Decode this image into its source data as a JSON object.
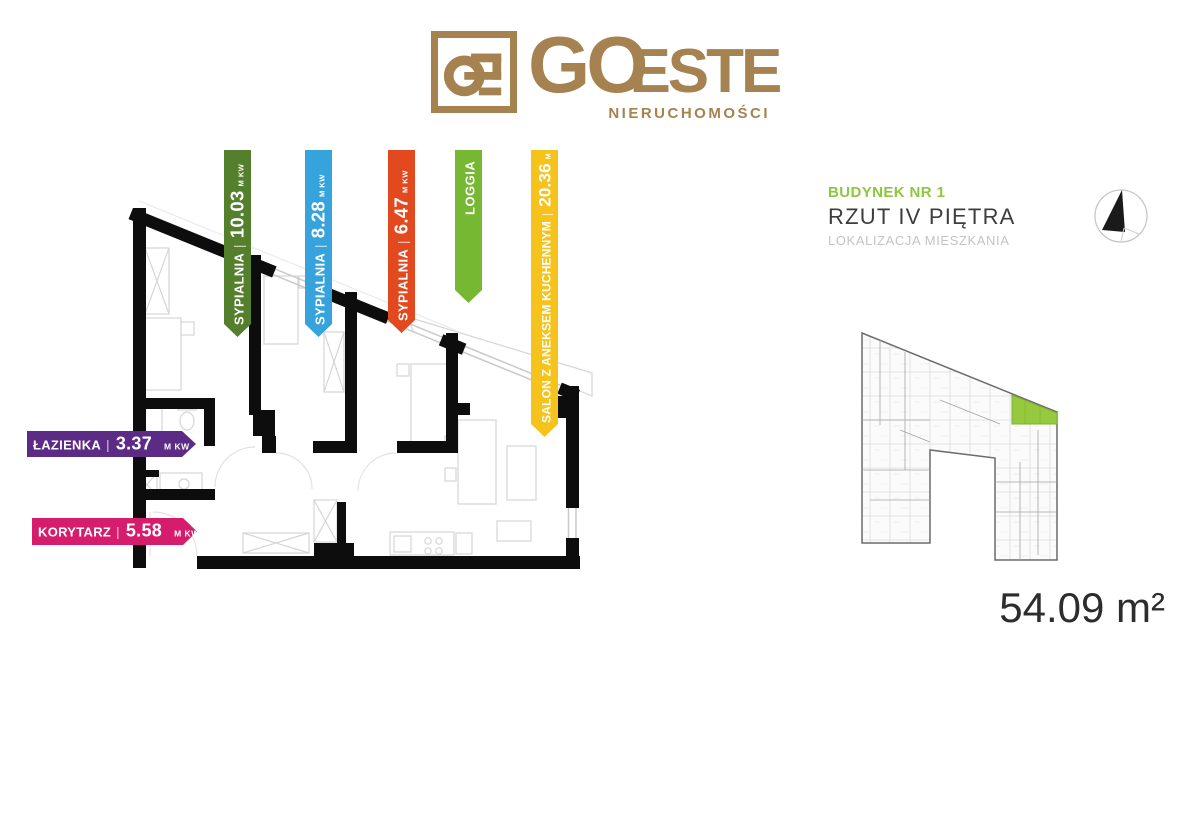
{
  "brand": {
    "monogram": "GE",
    "wordmark_go": "GO",
    "wordmark_este": "ESTE",
    "subtitle": "NIERUCHOMOŚCI",
    "color": "#a5824f"
  },
  "sep": "|",
  "flags": {
    "vertical": [
      {
        "room": "SYPIALNIA",
        "area": "10.03",
        "unit": "M KW",
        "color": "#547f2c"
      },
      {
        "room": "SYPIALNIA",
        "area": "8.28",
        "unit": "M KW",
        "color": "#36a3dc"
      },
      {
        "room": "SYPIALNIA",
        "area": "6.47",
        "unit": "M KW",
        "color": "#e2491f"
      },
      {
        "room": "LOGGIA",
        "area": "",
        "unit": "",
        "color": "#76b832"
      },
      {
        "room": "SALON Z ANEKSEM KUCHENNYM",
        "area": "20.36",
        "unit": "M KW",
        "color": "#f6c31c"
      }
    ],
    "horizontal": [
      {
        "room": "ŁAZIENKA",
        "area": "3.37",
        "unit": "M KW",
        "color": "#5c2b85"
      },
      {
        "room": "KORYTARZ",
        "area": "5.58",
        "unit": "M KW",
        "color": "#d61d6d"
      }
    ]
  },
  "location_panel": {
    "building_label": "BUDYNEK NR 1",
    "floor_label": "RZUT IV PIĘTRA",
    "sub_label": "LOKALIZACJA MIESZKANIA",
    "area_label": "54.09 m²",
    "building_label_color": "#8dc63f",
    "highlight_color": "#95c93e"
  }
}
